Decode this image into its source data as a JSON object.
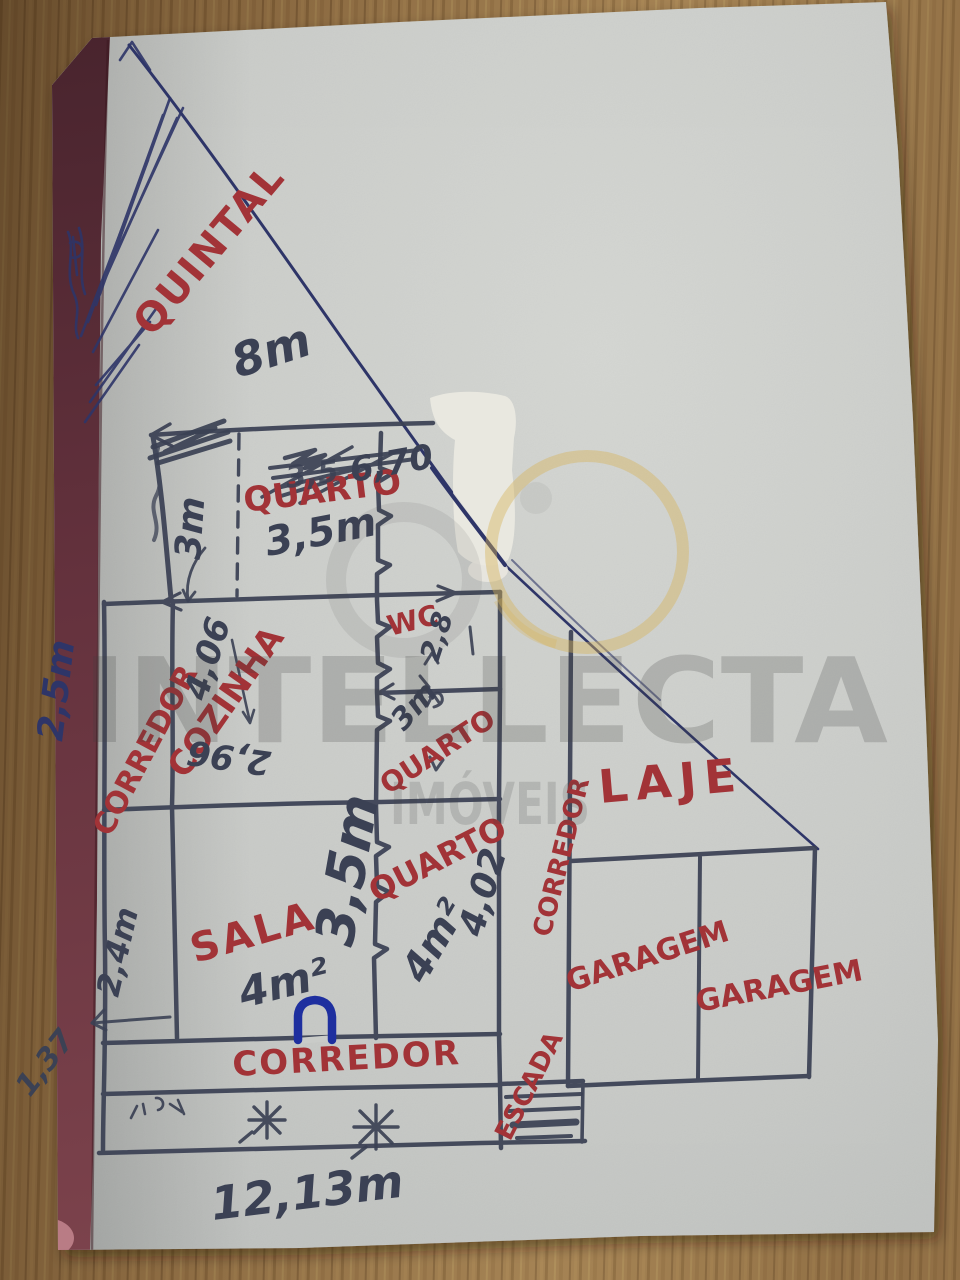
{
  "scene": {
    "description": "Hand-drawn floor plan sketch in pen on grey paper, photographed on a wooden table"
  },
  "watermark": {
    "brand": "INTELLECTA",
    "sub": "IMÓVEIS"
  },
  "rooms": {
    "quintal": "QUINTAL",
    "quarto_top": "QUARTO",
    "wc": "WC",
    "cozinha": "COZINHA",
    "corredor_left": "CORREDOR",
    "quarto_mid": "QUARTO",
    "quarto_low": "QUARTO",
    "laje": "LAJE",
    "corredor_right": "CORREDOR",
    "sala": "SALA",
    "garagem_left": "GARAGEM",
    "garagem_right": "GARAGEM",
    "corredor_bottom": "CORREDOR",
    "escada": "ESCADA"
  },
  "measures": {
    "quintal_diag": "8m",
    "seg_top": "6,70",
    "crossed_out": "3,5",
    "quarto_top_w": "3,5m",
    "quarto_top_h": "3m",
    "cozinha_h": "4,06",
    "cozinha_w": "2,96",
    "wc_w": "2,8",
    "quarto_mid_h": "3m",
    "mid_w_big": "3,5m",
    "quarto_low_area": "4m²",
    "quarto_low_h": "4,02",
    "sala_area": "4m²",
    "left_upper": "2,5m",
    "left_lower": "2,4m",
    "left_corner": "1,37",
    "total_w": "12,13m"
  },
  "colors": {
    "red_ink": "#a23337",
    "blue_ink": "#2e3568",
    "dark_ink": "#3b4154",
    "door_blue": "#1e2f9f",
    "paper": "#c9cbc8",
    "paper_edge_maroon": "#5d2a33",
    "wood": "#8a6a42",
    "watermark_gold": "#d7b258"
  }
}
